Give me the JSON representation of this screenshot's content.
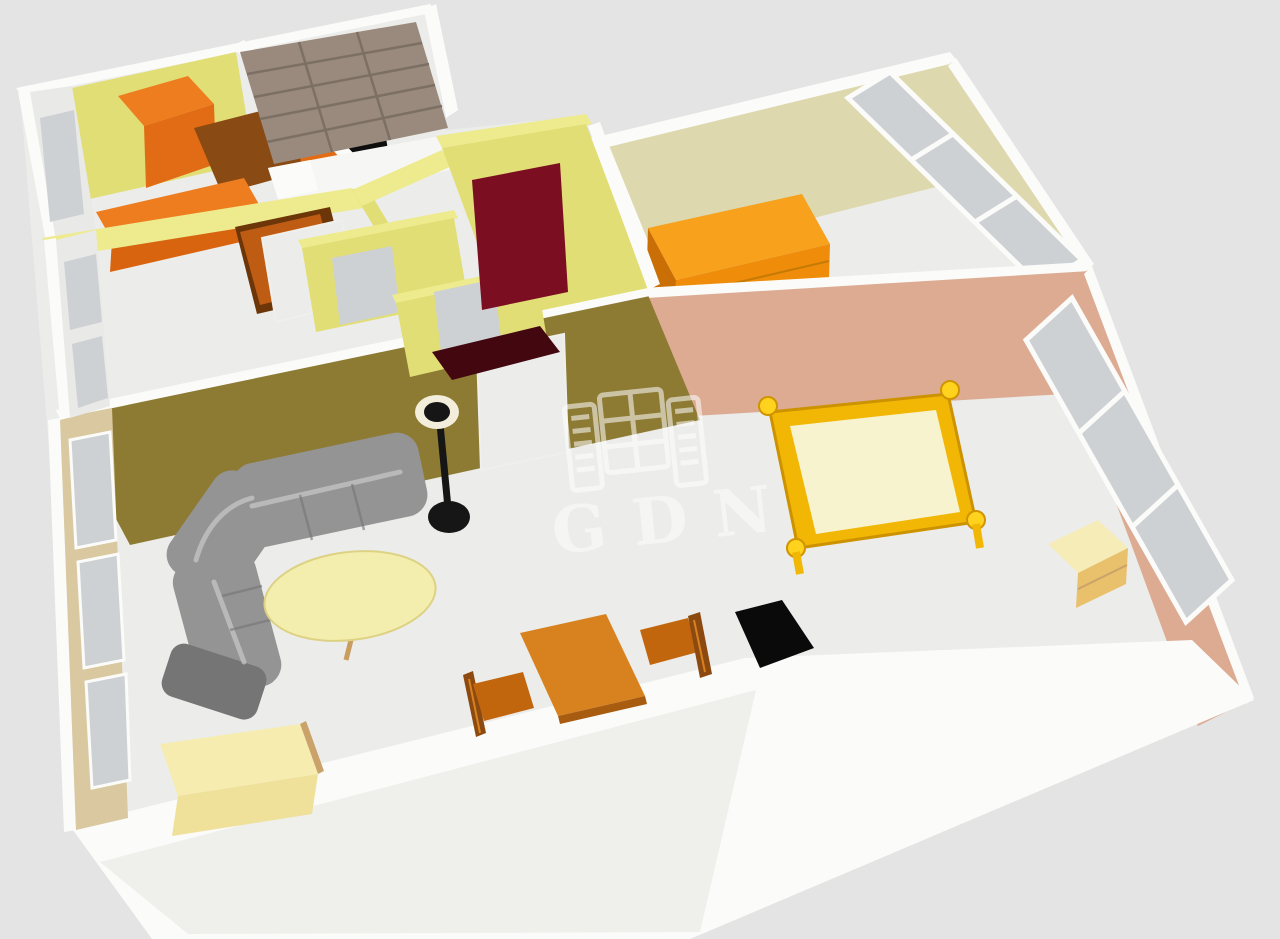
{
  "watermark": {
    "text": "GDN",
    "icon": "building-logo-icon"
  },
  "colors": {
    "bg": "#e4e4e4",
    "outer_white": "#fbfbf9",
    "outer_shade": "#efefec",
    "floor": "#ececea",
    "wall_yellow": "#e1de76",
    "wall_yellow_cap": "#edeb8d",
    "wall_white_face": "#e9e9e7",
    "glass": "#ced1d4",
    "wall_tan": "#d9c8a0",
    "wall_olive": "#8d7b33",
    "door_white": "#ecedea",
    "wall_beige": "#ddd8ae",
    "wall_pink": "#dcab92",
    "wardrobe_taupe": "#9a8a7d",
    "wardrobe_line": "#7c6f64",
    "bed_white": "#f6f6f4",
    "cabinet_orange": "#ee7d1f",
    "cabinet_orange_front": "#e26c15",
    "cabinet_dark": "#8a4a14",
    "cabinet_lower_front": "#d96410",
    "appliance_black": "#0e0e0e",
    "hall_door_orange": "#bf5c14",
    "hall_door_dark": "#6d3608",
    "door_maroon": "#7c0e22",
    "wc_floor_maroon": "#430710",
    "dresser_top": "#f7a11c",
    "dresser_front": "#ef8c0a",
    "dresser_side": "#c96f06",
    "drawer_line": "#c57a05",
    "bedframe_gold": "#f2b705",
    "bedframe_edge": "#cc9200",
    "mattress_cream": "#f8f3cf",
    "post_gold": "#ffd21e",
    "post_edge": "#cf9400",
    "nightstand_top": "#f6ecb8",
    "nightstand_front": "#e9c06c",
    "tv_black": "#0a0a0a",
    "sofa_gray": "#949494",
    "sofa_dark": "#757575",
    "sofa_light": "#c2c2c2",
    "table_cream": "#f4eeae",
    "table_edge": "#ddd183",
    "table_leg": "#c99d5f",
    "lamp_black": "#161616",
    "lamp_shade": "#f2eedb",
    "dining_top": "#d8821f",
    "dining_edge": "#a85c10",
    "chair_seat": "#c2660e",
    "chair_back": "#8c4a10",
    "sideboard_top": "#f6ecb0",
    "sideboard_front": "#efe09a",
    "sideboard_side": "#caa36a",
    "watermark_white": "#ffffff"
  }
}
